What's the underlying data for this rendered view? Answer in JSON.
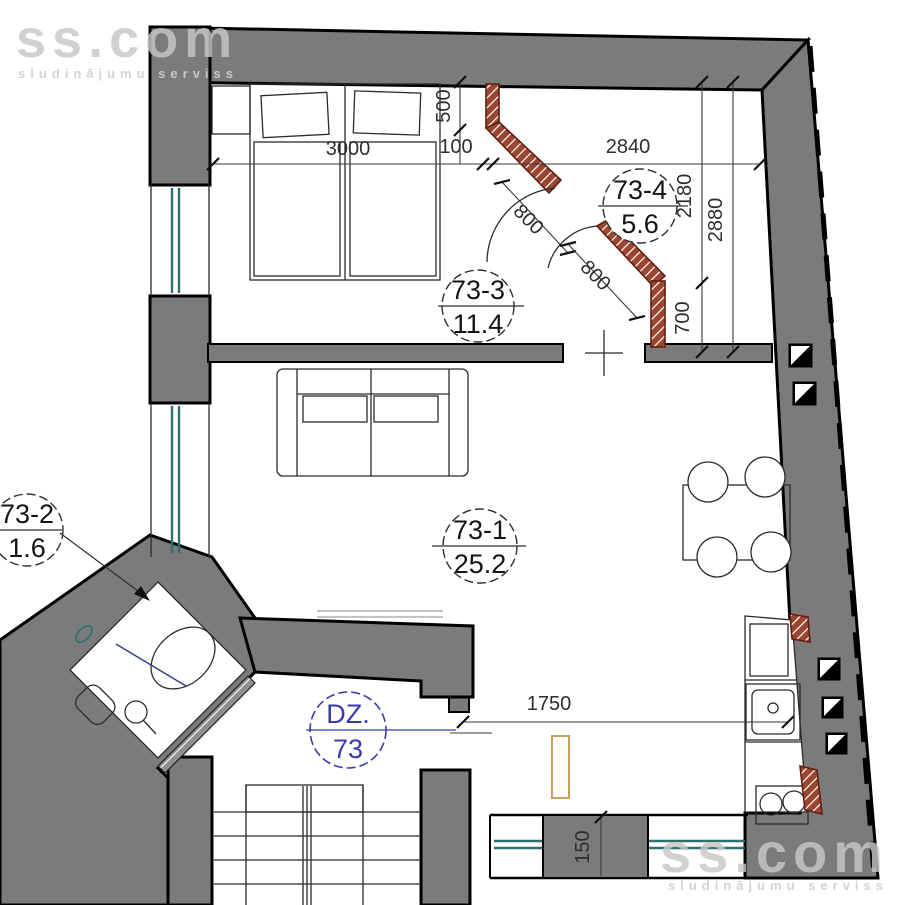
{
  "watermark": {
    "brand": "ss.com",
    "tagline": "sludinājumu serviss"
  },
  "rooms": {
    "living": {
      "id": "73-1",
      "area": "25.2"
    },
    "bath": {
      "id": "73-2",
      "area": "1.6"
    },
    "bedroom": {
      "id": "73-3",
      "area": "11.4"
    },
    "hall": {
      "id": "73-4",
      "area": "5.6"
    },
    "apartment": {
      "code": "DZ.",
      "number": "73"
    }
  },
  "dimensions": {
    "bed_wall": "3000",
    "wall_gap": "100",
    "hall_width": "2840",
    "niche_depth": "500",
    "hall_height_upper": "2180",
    "hall_height_lower": "700",
    "hall_height_total": "2880",
    "door_a": "800",
    "door_b": "800",
    "entry_width": "1750",
    "pier": "150"
  },
  "colors": {
    "wall_gray": "#7b7b7b",
    "brick_hatch": "#9a4630",
    "window_teal": "#2e6f6f",
    "label_blue": "#3a3aad",
    "radiator_tan": "#c9a063"
  }
}
